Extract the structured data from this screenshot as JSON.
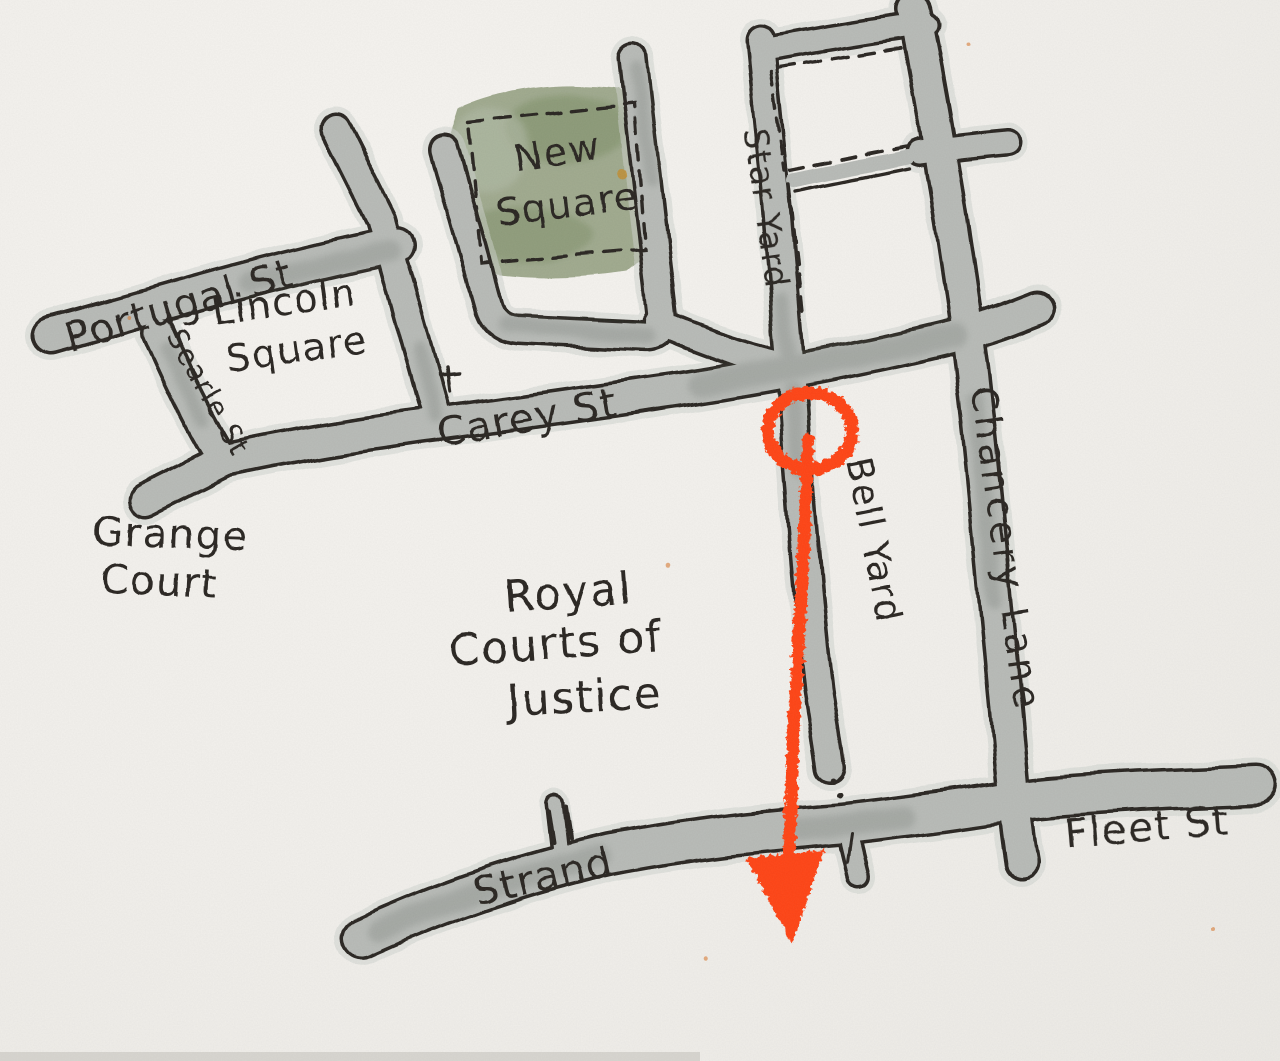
{
  "map": {
    "colors": {
      "paper": "#f2f0ec",
      "ink": "#2b2823",
      "road": "#b8bbb7",
      "halo": "#ced2ce",
      "pool": "#767b76",
      "green": "#97a284",
      "green_dark": "#7d8f66",
      "green_light": "#b2baa6",
      "route": "#ff4517",
      "gold_dot": "#c18f35",
      "speck": "#d97b35"
    },
    "labels": {
      "portugal_st": "Portugal St",
      "searle_st": "Searle St",
      "lincoln_square_line1": "Lincoln",
      "lincoln_square_line2": "Square",
      "new_square_line1": "New",
      "new_square_line2": "Square",
      "grange_court_line1": "Grange",
      "grange_court_line2": "Court",
      "carey_st": "Carey St",
      "star_yard": "Star Yard",
      "bell_yard": "Bell Yard",
      "chancery_lane": "Chancery Lane",
      "royal_courts_line1": "Royal",
      "royal_courts_line2": "Courts of",
      "royal_courts_line3": "Justice",
      "strand": "Strand",
      "fleet_st": "Fleet St"
    },
    "route_marker": {
      "color": "#ff4517",
      "start": "circle",
      "end": "arrowhead"
    }
  }
}
